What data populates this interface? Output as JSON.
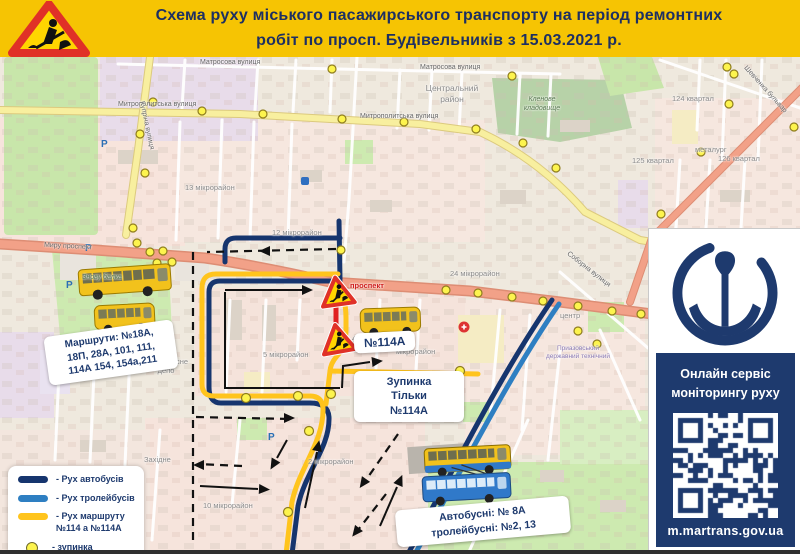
{
  "header": {
    "title_line1": "Схема руху міського пасажирського транспорту на період ремонтних",
    "title_line2": "робіт по просп. Будівельників з 15.03.2021 р."
  },
  "callouts": {
    "routes_box": {
      "line1": "Маршрути: №18А,",
      "line2": "18П, 28А, 101, 111,",
      "line3": "114А 154, 154а,211"
    },
    "route_114a": "№114А",
    "stop_only": {
      "line1": "Зупинка",
      "line2": "Тільки",
      "line3": "№114А"
    },
    "buses_box": {
      "line1": "Автобусні: № 8А",
      "line2": "тролейбусні: №2, 13"
    }
  },
  "legend": {
    "items": [
      {
        "label": "- Рух автобусів",
        "color": "#16356e",
        "shape": "bar"
      },
      {
        "label": "- Рух тролейбусів",
        "color": "#2e7fc2",
        "shape": "bar"
      },
      {
        "label": "- Рух маршруту",
        "label2": "№114 а №114А",
        "color": "#ffc41d",
        "shape": "bar"
      },
      {
        "label": "- зупинка",
        "color": "#fdf44e",
        "shape": "dot"
      }
    ]
  },
  "sidebar": {
    "line1": "Онлайн сервіс",
    "line2": "моніторингу руху",
    "url": "m.martrans.gov.ua"
  },
  "icons": {
    "roadwork": "roadwork-triangle",
    "anchor": "anchor-logo",
    "qr": "qr-code",
    "parking": "P",
    "hospital": "+"
  },
  "colors": {
    "header_bg": "#f6c403",
    "navy_text": "#1d2f63",
    "bus_route": "#16356e",
    "trolley_route": "#2e7fc2",
    "marshrutka_route": "#ffc41d",
    "stop_fill": "#fdf44e",
    "closed_road": "#e02020",
    "road_primary": "#f2a188",
    "road_secondary": "#f8ef9f"
  },
  "map": {
    "labels": [
      {
        "text": "Матросова вулиця"
      },
      {
        "text": "Матросова вулиця"
      },
      {
        "text": "Митрополитська вулиця"
      },
      {
        "text": "Митрополитська вулиця"
      },
      {
        "text": "Центральний район"
      },
      {
        "text": "Кленове кладовище"
      },
      {
        "text": "13 мікрорайон"
      },
      {
        "text": "12 мікрорайон"
      },
      {
        "text": "24 мікрорайон"
      },
      {
        "text": "5 мікрорайон"
      },
      {
        "text": "2 мікрорайон"
      },
      {
        "text": "10 мікрорайон"
      },
      {
        "text": "4 мікрорайон"
      },
      {
        "text": "мікрорайон"
      },
      {
        "text": "центр"
      },
      {
        "text": "124 квартал"
      },
      {
        "text": "125 квартал"
      },
      {
        "text": "126 квартал"
      },
      {
        "text": "Шевченка бульвар"
      },
      {
        "text": "Купріна вулиця"
      },
      {
        "text": "Миру проспект"
      },
      {
        "text": "проспект"
      },
      {
        "text": "Соборна вулиця"
      },
      {
        "text": "тролейбусне депо"
      },
      {
        "text": "Знову балка"
      },
      {
        "text": "Західне"
      },
      {
        "text": "металург"
      },
      {
        "text": "Приазовський державний технічний"
      }
    ]
  }
}
